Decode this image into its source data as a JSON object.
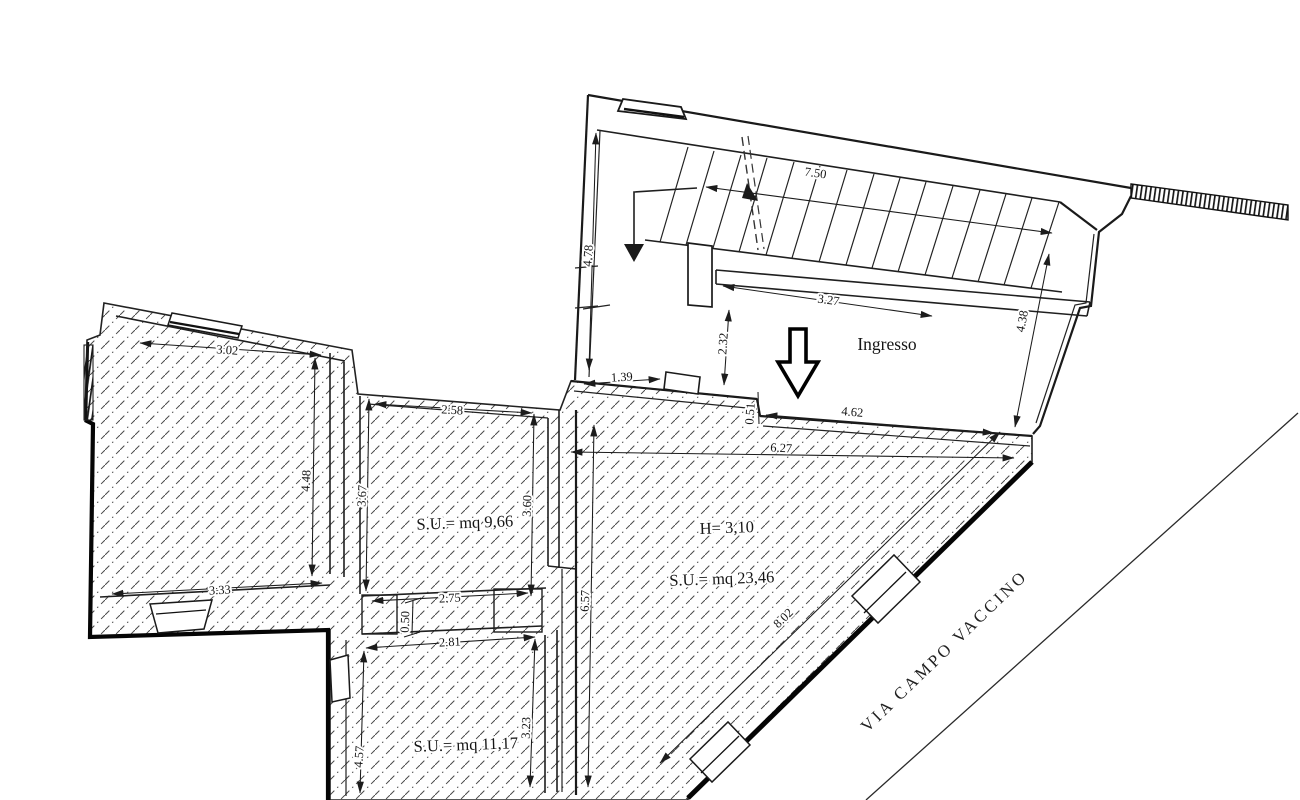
{
  "street": {
    "name": "VIA CAMPO VACCINO"
  },
  "rooms": {
    "entrance_hall": {
      "label": "Ingresso"
    },
    "room_a": {
      "area_label": "S.U.= mq 9,66"
    },
    "room_b": {
      "height_label": "H= 3,10",
      "area_label": "S.U.= mq 23,46"
    },
    "room_c": {
      "area_label": "S.U.= mq 11,17"
    }
  },
  "dimensions": {
    "stairs_run": "7.50",
    "stairwell_left_depth": "4.78",
    "stair_landing_width": "3.27",
    "hall_left_depth": "2.32",
    "hall_right_depth": "4.38",
    "hall_door_offset": "1.39",
    "entry_front_width": "4.62",
    "entry_step_depth": "0.51",
    "main_room_top_width": "6.27",
    "left_room_top_width": "3.02",
    "left_room_right_depth": "4.48",
    "left_room_bottom_width": "3.33",
    "mid_room_left_depth": "3.67",
    "mid_room_top_width": "2.58",
    "mid_room_right_depth": "3.60",
    "mid_room_bottom_width": "2.75",
    "passage_jog": "0.50",
    "bottom_room_top_width": "2.81",
    "bottom_room_left_depth": "4.57",
    "bottom_room_right_depth": "3.23",
    "main_room_left_depth": "6.57",
    "street_wall_length": "8.02"
  }
}
